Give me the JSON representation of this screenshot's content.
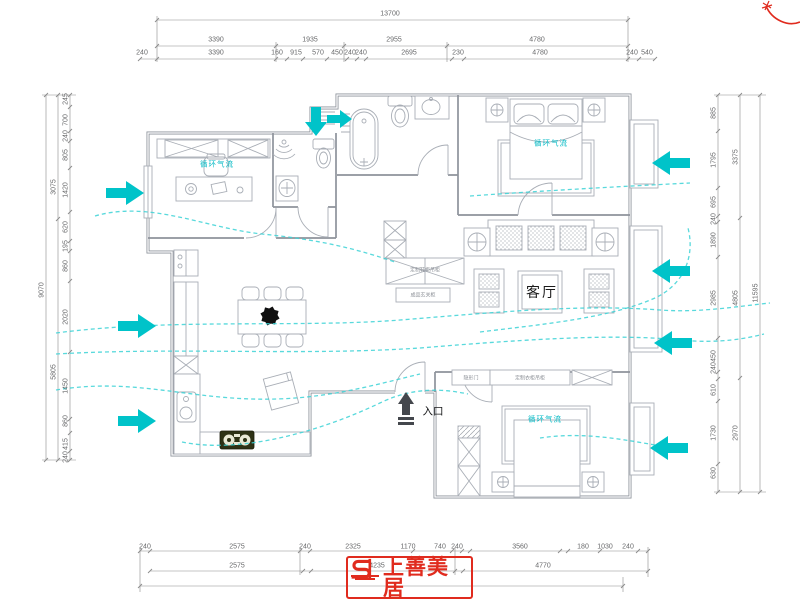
{
  "dims": {
    "top": {
      "total": "13700",
      "row1": [
        "3390",
        "1935",
        "2955",
        "4780"
      ],
      "row2": [
        "240",
        "3390",
        "160",
        "915",
        "570",
        "450",
        "240",
        "240",
        "2695",
        "230",
        "4780",
        "240",
        "540"
      ]
    },
    "left": {
      "total": "9070",
      "mid": [
        "3075",
        "5805"
      ],
      "inner": [
        "245",
        "700",
        "240",
        "805",
        "1420",
        "620",
        "195",
        "860",
        "2020",
        "1450",
        "860",
        "415",
        "240"
      ]
    },
    "right": {
      "total": "11595",
      "mid": [
        "3375",
        "4805",
        "2970"
      ],
      "inner": [
        "885",
        "1795",
        "695",
        "240",
        "1890",
        "2985",
        "450",
        "240",
        "610",
        "1730",
        "630"
      ]
    },
    "bottom": {
      "row1": [
        "240",
        "2575",
        "240",
        "2325",
        "1170",
        "740",
        "240",
        "3560",
        "180",
        "1030",
        "240"
      ],
      "row2": [
        "2575",
        "4235",
        "4770"
      ]
    }
  },
  "plan": {
    "living_room": "客厅",
    "entrance": "入口",
    "airflow1": "循环气流",
    "airflow2": "循环气流",
    "airflow3": "循环气流",
    "cabinet_top": "定制鞋柜吊柜",
    "cabinet_bottom": "成品玄关柜",
    "bedroom2_door": "隐形门",
    "bedroom2_wardrobe": "定制衣柜吊柜"
  },
  "logo": {
    "brand": "上善美居"
  },
  "colors": {
    "accent_cyan": "#00c3c9",
    "brand_red": "#e02b1e",
    "line_gray": "#8e939b"
  }
}
